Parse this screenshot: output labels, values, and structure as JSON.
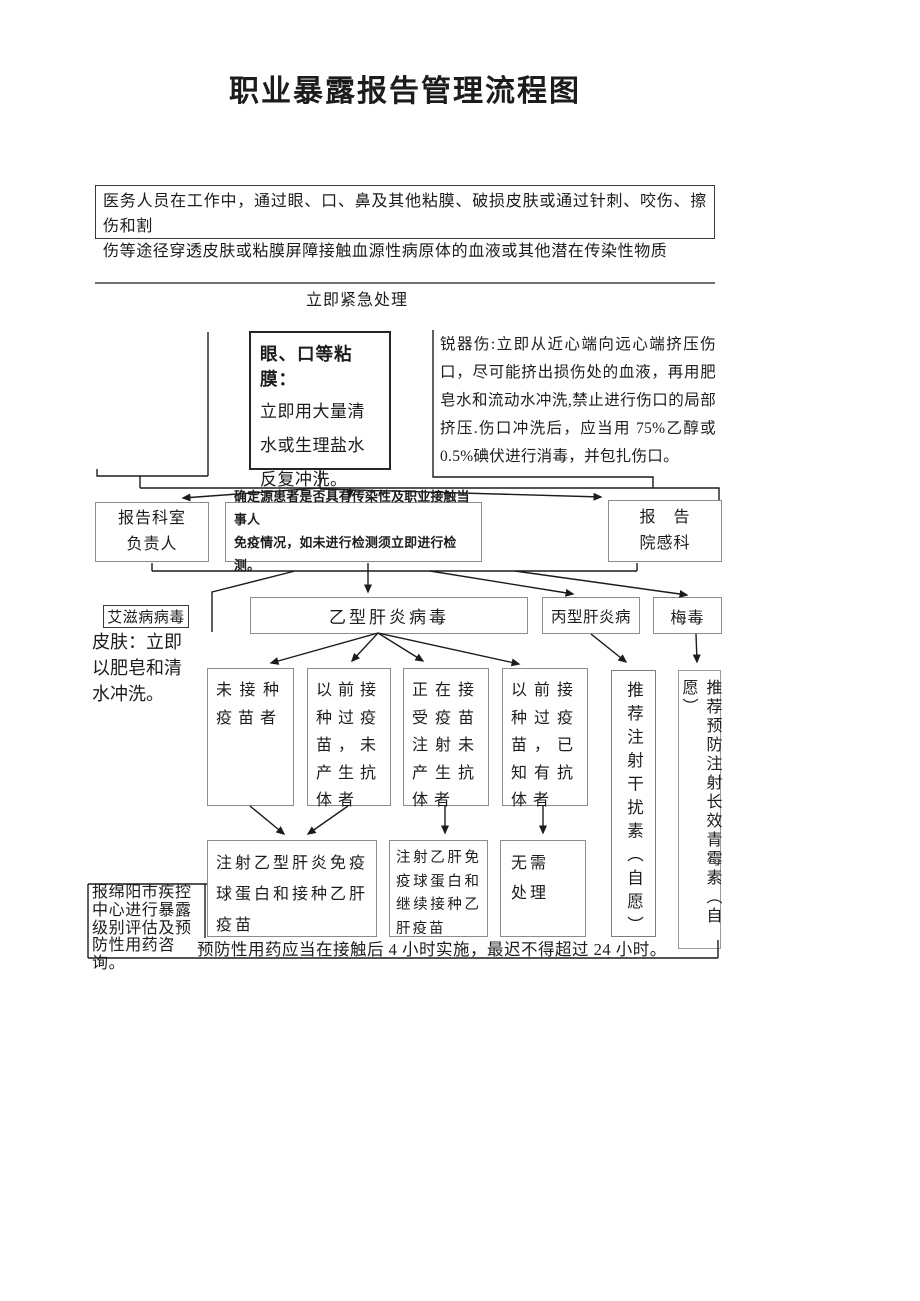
{
  "title": "职业暴露报告管理流程图",
  "intro": {
    "text": "医务人员在工作中，通过眼、口、鼻及其他粘膜、破损皮肤或通过针刺、咬伤、擦伤和割\n伤等途径穿透皮肤或粘膜屏障接触血源性病原体的血液或其他潜在传染性物质"
  },
  "emergency_label": "立即紧急处理",
  "mucosa": {
    "title": "眼、口等粘膜：",
    "body": "立即用大量清水或生理盐水反复冲洗。"
  },
  "sharp_injury": "锐器伤:立即从近心端向远心端挤压伤口，尽可能挤出损伤处的血液，再用肥皂水和流动水冲洗,禁止进行伤口的局部挤压.伤口冲洗后，应当用 75%乙醇或 0.5%碘伏进行消毒，并包扎伤口。",
  "report": {
    "dept_head": "报告科室\n负责人",
    "assess": "确定源患者是否具有传染性及职业接触当事人\n免疫情况，如未进行检测须立即进行检测。",
    "infection_dept": "报　告\n院感科"
  },
  "hiv": {
    "label": "艾滋病病毒",
    "note": "皮肤：立即以肥皂和清水冲洗。"
  },
  "viruses": {
    "hbv": "乙型肝炎病毒",
    "hcv": "丙型肝炎病",
    "syphilis": "梅毒"
  },
  "hbv_status": [
    "未接种疫苗者",
    "以前接种过疫苗，未产生抗体者",
    "正在接受疫苗注射未产生抗体者",
    "以前接种过疫苗，已知有抗体者"
  ],
  "actions": {
    "hbig_vaccinate": "注射乙型肝炎免疫球蛋白和接种乙肝疫苗",
    "hbig_continue": "注射乙肝免疫球蛋白和继续接种乙肝疫苗",
    "no_treatment": "无需\n处理",
    "interferon": "推荐注射干扰素（自愿）",
    "penicillin": "推荐预防注射长效青霉素（自愿）"
  },
  "cdc_note": "报绵阳市疾控中心进行暴露级别评估及预防性用药咨询。",
  "timing_note": "预防性用药应当在接触后 4 小时实施，最迟不得超过 24 小时。"
}
